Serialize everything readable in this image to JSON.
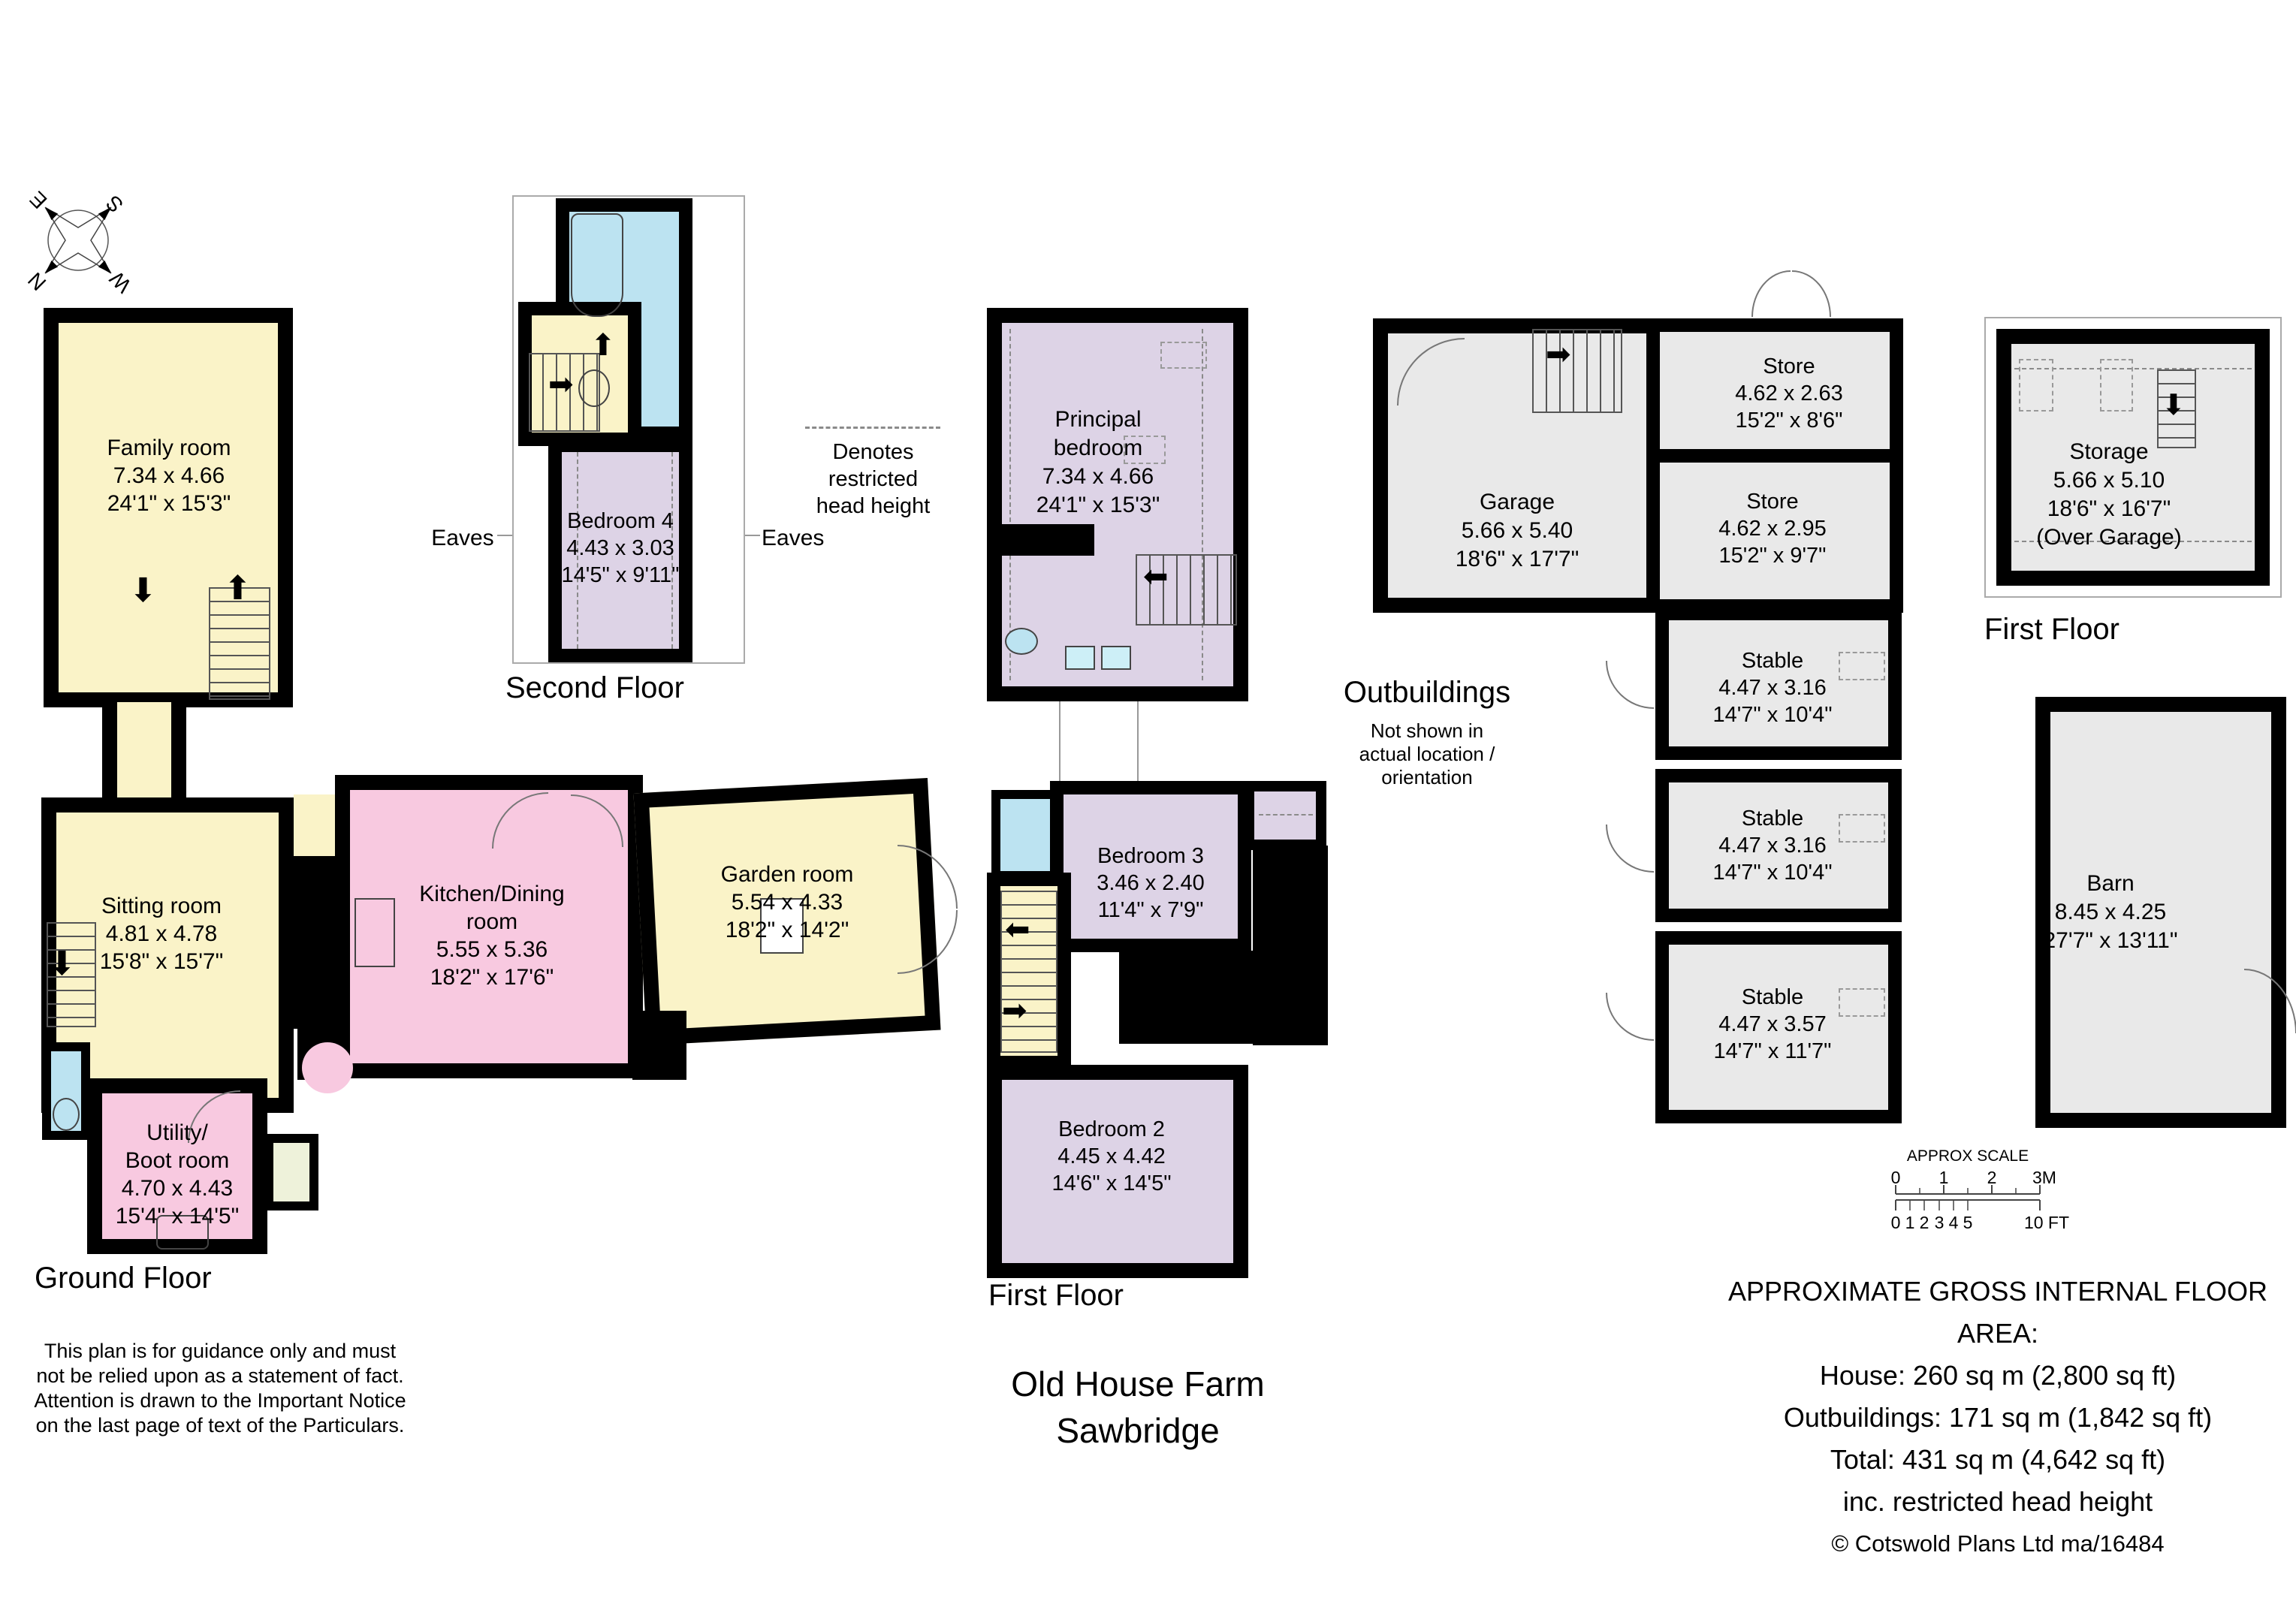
{
  "title": {
    "line1": "Old House Farm",
    "line2": "Sawbridge"
  },
  "compass": {
    "north": "N",
    "south": "S",
    "east": "E",
    "west": "W"
  },
  "floor_labels": {
    "ground": "Ground Floor",
    "second": "Second Floor",
    "first_house": "First Floor",
    "first_garage": "First Floor"
  },
  "rooms": {
    "family": {
      "name": "Family room",
      "metric": "7.34 x 4.66",
      "imperial": "24'1\" x 15'3\""
    },
    "sitting": {
      "name": "Sitting room",
      "metric": "4.81 x 4.78",
      "imperial": "15'8\" x 15'7\""
    },
    "kitchen": {
      "name": "Kitchen/Dining",
      "name2": "room",
      "metric": "5.55 x 5.36",
      "imperial": "18'2\" x 17'6\""
    },
    "garden": {
      "name": "Garden room",
      "metric": "5.54 x 4.33",
      "imperial": "18'2\" x 14'2\""
    },
    "utility": {
      "name": "Utility/",
      "name2": "Boot room",
      "metric": "4.70 x 4.43",
      "imperial": "15'4\" x 14'5\""
    },
    "bedroom4": {
      "name": "Bedroom 4",
      "metric": "4.43 x 3.03",
      "imperial": "14'5\" x 9'11\""
    },
    "principal": {
      "name": "Principal",
      "name2": "bedroom",
      "metric": "7.34 x 4.66",
      "imperial": "24'1\" x 15'3\""
    },
    "bedroom3": {
      "name": "Bedroom 3",
      "metric": "3.46 x 2.40",
      "imperial": "11'4\" x 7'9\""
    },
    "bedroom2": {
      "name": "Bedroom 2",
      "metric": "4.45 x 4.42",
      "imperial": "14'6\" x 14'5\""
    },
    "garage": {
      "name": "Garage",
      "metric": "5.66 x 5.40",
      "imperial": "18'6\" x 17'7\""
    },
    "store1": {
      "name": "Store",
      "metric": "4.62 x 2.63",
      "imperial": "15'2\" x 8'6\""
    },
    "store2": {
      "name": "Store",
      "metric": "4.62 x 2.95",
      "imperial": "15'2\" x 9'7\""
    },
    "stable1": {
      "name": "Stable",
      "metric": "4.47 x 3.16",
      "imperial": "14'7\" x 10'4\""
    },
    "stable2": {
      "name": "Stable",
      "metric": "4.47 x 3.16",
      "imperial": "14'7\" x 10'4\""
    },
    "stable3": {
      "name": "Stable",
      "metric": "4.47 x 3.57",
      "imperial": "14'7\" x 11'7\""
    },
    "storage": {
      "name": "Storage",
      "metric": "5.66 x 5.10",
      "imperial": "18'6\" x 16'7\"",
      "extra": "(Over Garage)"
    },
    "barn": {
      "name": "Barn",
      "metric": "8.45 x 4.25",
      "imperial": "27'7\" x 13'11\""
    }
  },
  "annotations": {
    "eaves_left": "Eaves",
    "eaves_right": "Eaves",
    "restricted_line1": "Denotes restricted",
    "restricted_line2": "head height",
    "outbuildings_heading": "Outbuildings",
    "outbuildings_note1": "Not shown in",
    "outbuildings_note2": "actual location /",
    "outbuildings_note3": "orientation"
  },
  "scale_bar": {
    "title": "APPROX SCALE",
    "metric_ticks": [
      "0",
      "1",
      "2",
      "3M"
    ],
    "imperial_ticks": [
      "0",
      "1",
      "2",
      "3",
      "4",
      "5",
      "10 FT"
    ]
  },
  "area_summary": {
    "heading": "APPROXIMATE GROSS INTERNAL FLOOR AREA:",
    "house": "House: 260 sq m (2,800 sq ft)",
    "outbuildings": "Outbuildings: 171 sq m (1,842 sq ft)",
    "total": "Total: 431 sq m (4,642 sq ft)",
    "note": "inc. restricted head height",
    "credit": "© Cotswold Plans Ltd ma/16484"
  },
  "disclaimer": {
    "line1": "This plan is for guidance only and must",
    "line2": "not be relied upon as a statement of fact.",
    "line3": "Attention is drawn to the Important Notice",
    "line4": "on the last page of text of the Particulars."
  },
  "icons": {
    "arrow_up": "⬆",
    "arrow_down": "⬇",
    "arrow_left": "⬅",
    "arrow_right": "➡"
  },
  "colors": {
    "room_yellow": "#FAF3C8",
    "room_pink": "#F8C9E0",
    "room_lavender": "#DDD3E6",
    "room_blue": "#BCE3F1",
    "room_grey": "#E9E9E9",
    "room_green": "#EEF2DA",
    "wall": "#000000"
  }
}
